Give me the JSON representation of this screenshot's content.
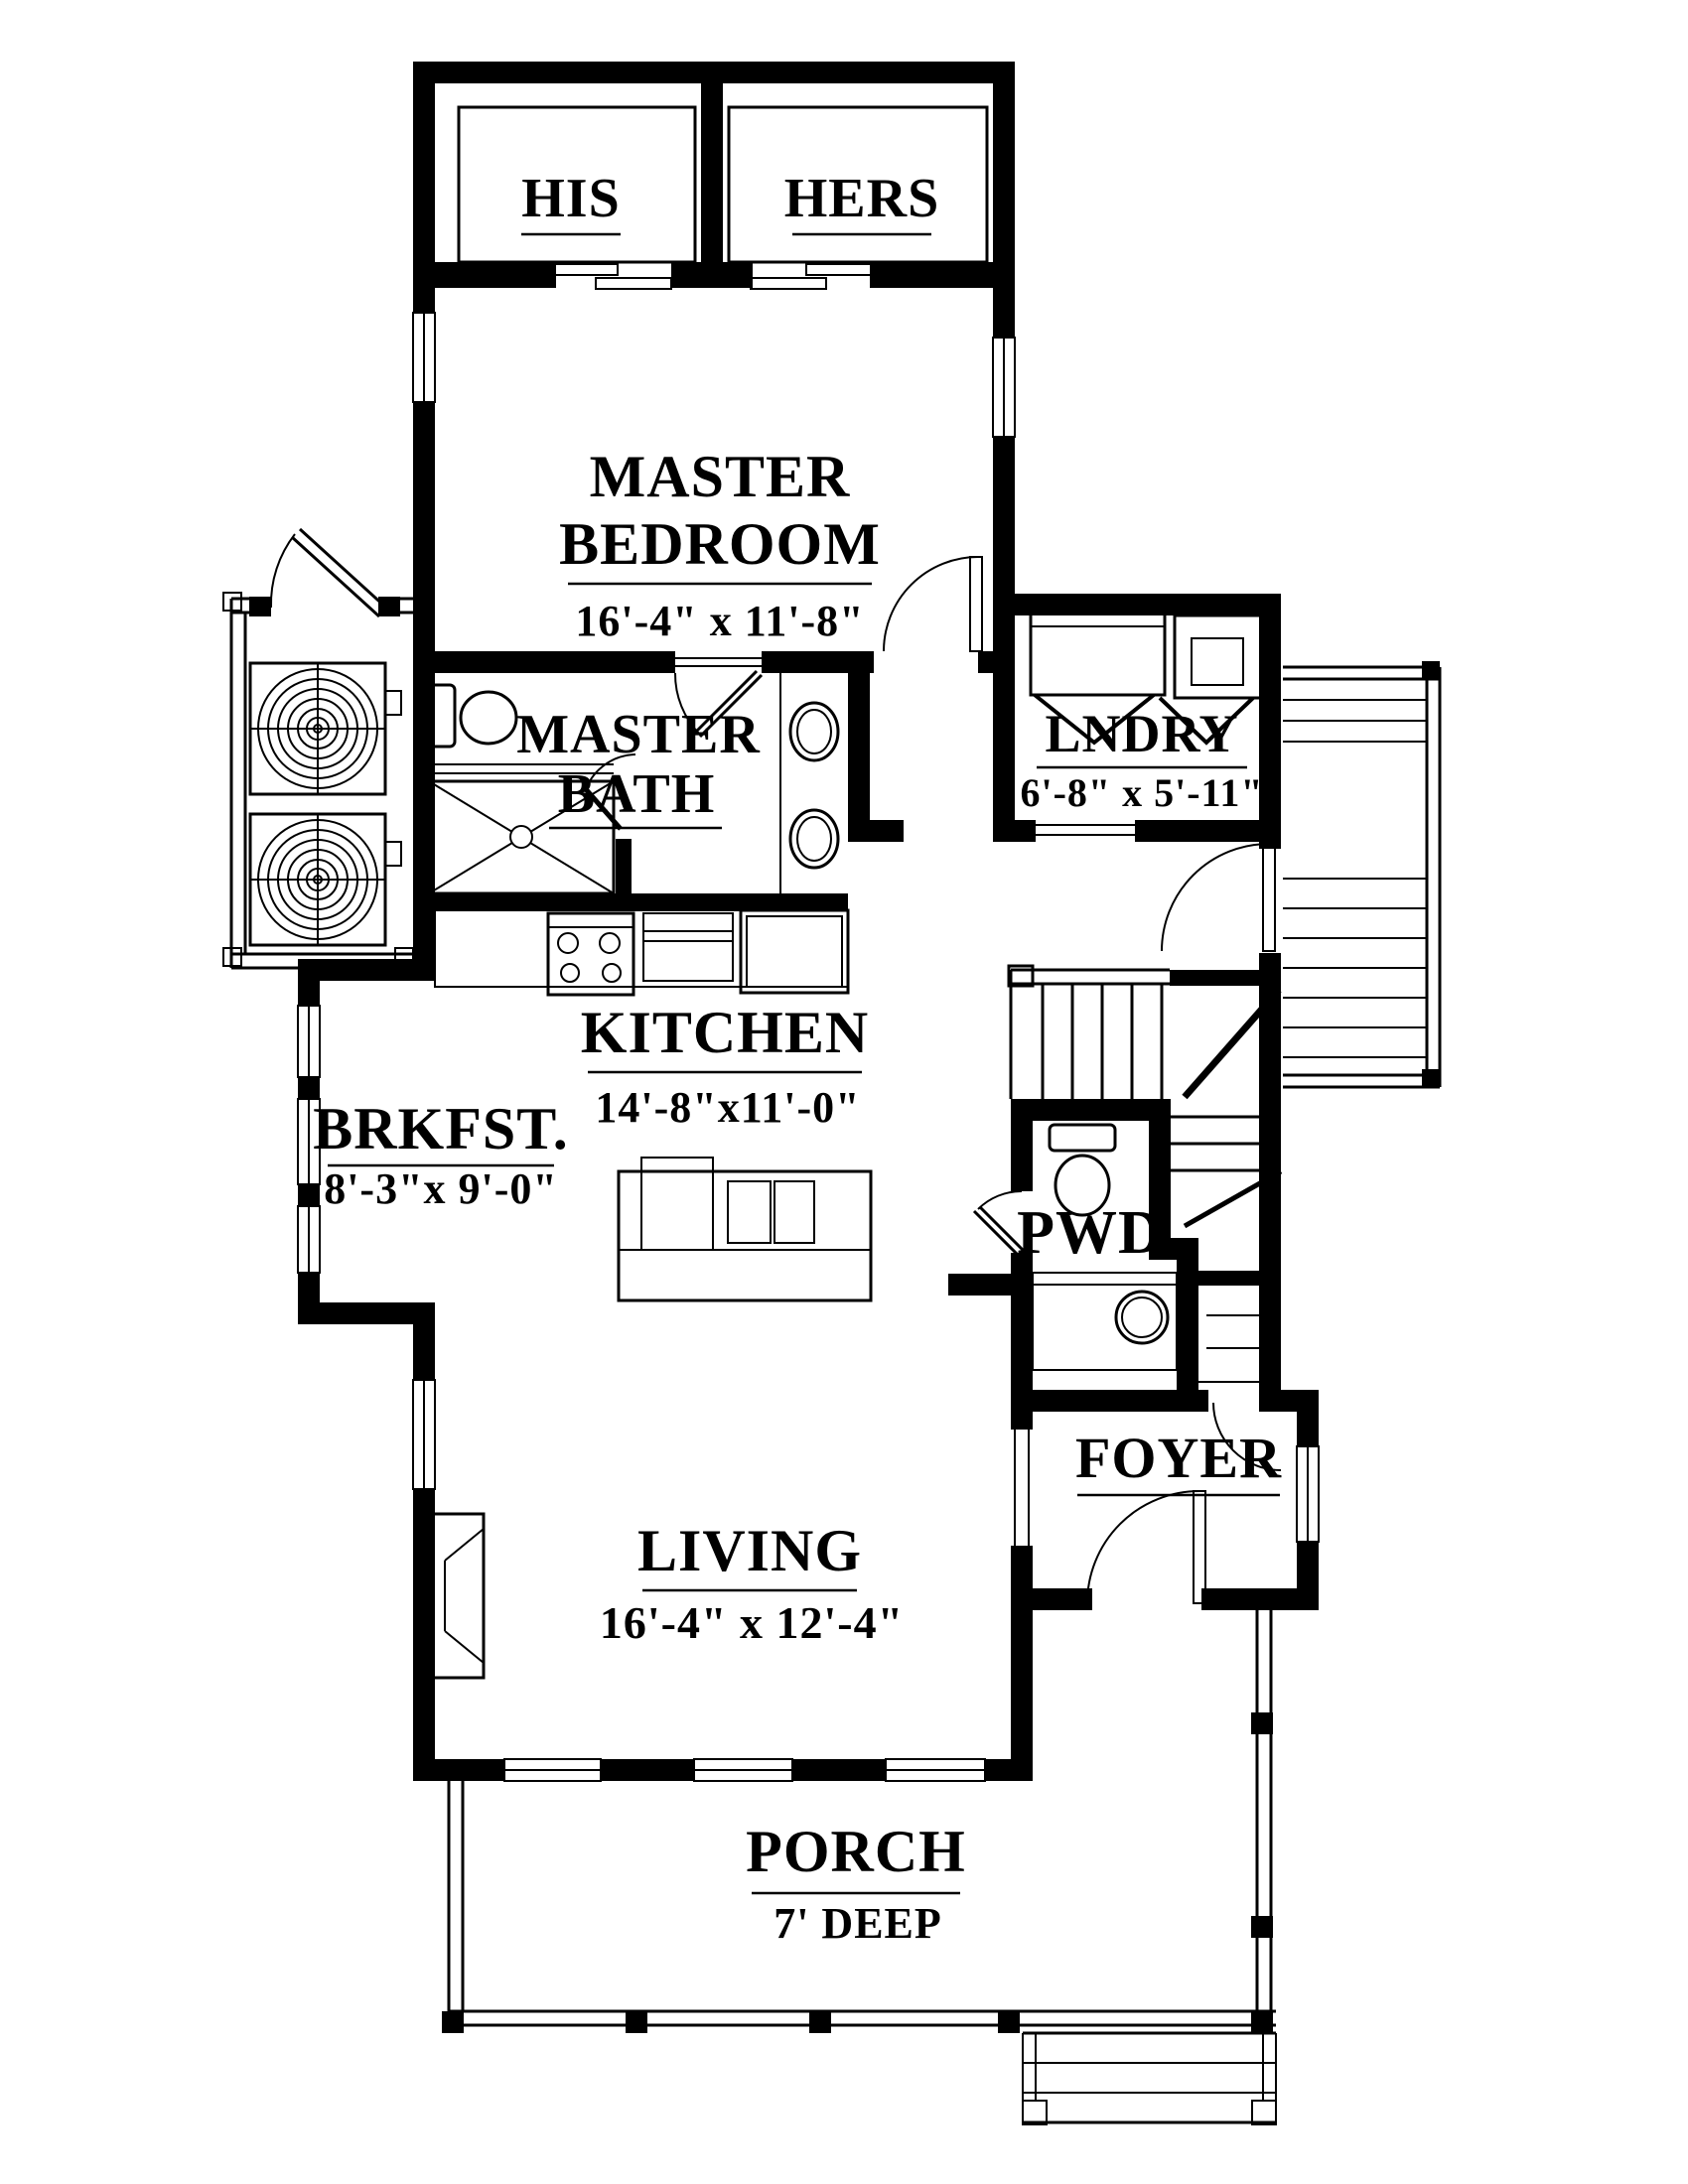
{
  "colors": {
    "ink": "#000000",
    "paper": "#ffffff"
  },
  "rooms": {
    "his": {
      "label": "HIS"
    },
    "hers": {
      "label": "HERS"
    },
    "master_bedroom": {
      "line1": "MASTER",
      "line2": "BEDROOM",
      "dims": "16'-4\" x 11'-8\""
    },
    "master_bath": {
      "line1": "MASTER",
      "line2": "BATH"
    },
    "laundry": {
      "label": "LNDRY",
      "dims": "6'-8\" x 5'-11\""
    },
    "kitchen": {
      "label": "KITCHEN",
      "dims": "14'-8\"x11'-0\""
    },
    "breakfast": {
      "label": "BRKFST.",
      "dims": "8'-3\"x 9'-0\""
    },
    "powder": {
      "label": "PWD"
    },
    "foyer": {
      "label": "FOYER"
    },
    "living": {
      "label": "LIVING",
      "dims": "16'-4\" x 12'-4\""
    },
    "porch": {
      "label": "PORCH",
      "dims": "7' DEEP"
    }
  }
}
